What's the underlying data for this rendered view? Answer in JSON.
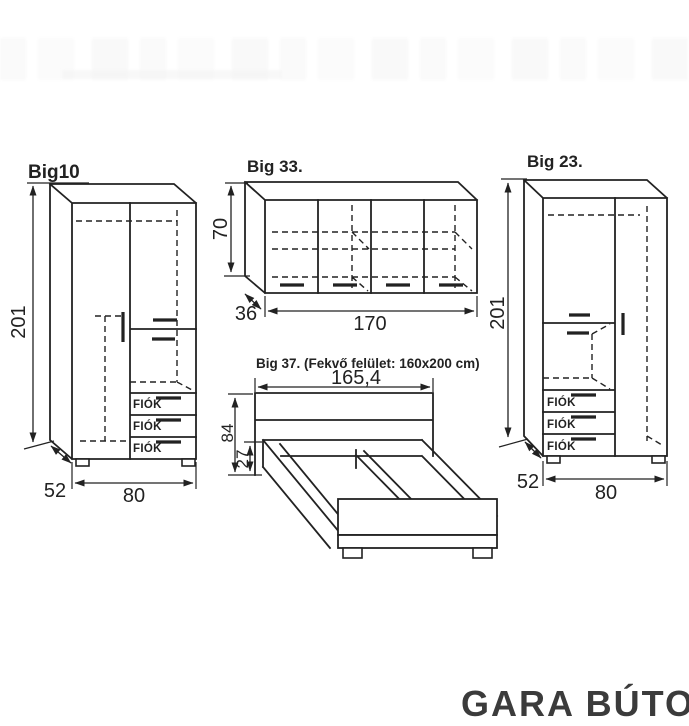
{
  "colors": {
    "line": "#222222",
    "brand": "#3b3b3b",
    "background": "#ffffff"
  },
  "brand": {
    "text": "GARA BÚTOR"
  },
  "furniture": {
    "wardrobe_big10": {
      "title": "Big10",
      "height_cm": "201",
      "depth_cm": "52",
      "width_cm": "80",
      "drawers": [
        "FIÓK",
        "FIÓK",
        "FIÓK"
      ]
    },
    "wall_cabinet_big33": {
      "title": "Big 33.",
      "height_cm": "70",
      "depth_cm": "36",
      "width_cm": "170"
    },
    "wardrobe_big23": {
      "title": "Big 23.",
      "height_cm": "201",
      "depth_cm": "52",
      "width_cm": "80",
      "drawers": [
        "FIÓK",
        "FIÓK",
        "FIÓK"
      ]
    },
    "bed_big37": {
      "title": "Big 37. (Fekvő felület: 160x200 cm)",
      "width_cm": "165,4",
      "height_cm": "84",
      "frame_height_cm": "27"
    }
  }
}
